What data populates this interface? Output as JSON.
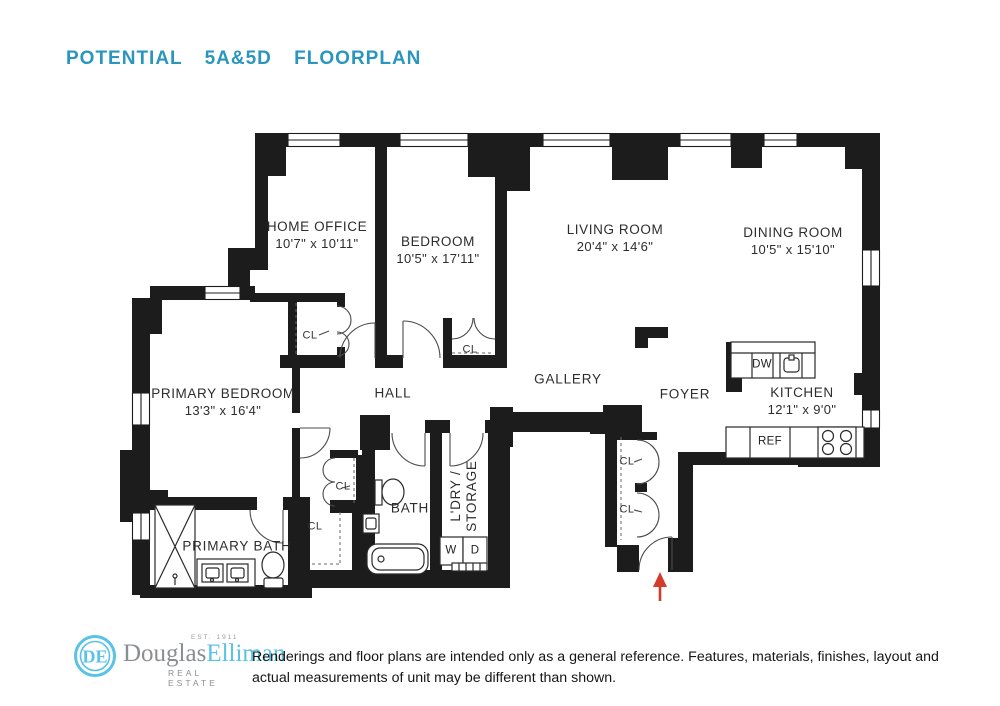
{
  "title": "POTENTIAL  5A&5D  FLOORPLAN",
  "colors": {
    "accent_teal": "#2a96bd",
    "wall_black": "#1c1c1c",
    "arrow_red": "#d23b29",
    "logo_blue": "#5bc2e7",
    "logo_gray": "#8b8e91"
  },
  "rooms": [
    {
      "id": "home-office",
      "name": "HOME OFFICE",
      "dims": "10'7\" x 10'11\""
    },
    {
      "id": "bedroom",
      "name": "BEDROOM",
      "dims": "10'5\" x 17'11\""
    },
    {
      "id": "living-room",
      "name": "LIVING ROOM",
      "dims": "20'4\" x 14'6\""
    },
    {
      "id": "dining-room",
      "name": "DINING ROOM",
      "dims": "10'5\" x 15'10\""
    },
    {
      "id": "primary-bedroom",
      "name": "PRIMARY BEDROOM",
      "dims": "13'3\" x 16'4\""
    },
    {
      "id": "kitchen",
      "name": "KITCHEN",
      "dims": "12'1\" x 9'0\""
    }
  ],
  "areas": {
    "hall": "HALL",
    "gallery": "GALLERY",
    "foyer": "FOYER",
    "bath": "BATH",
    "primary_bath": "PRIMARY BATH",
    "laundry_line1": "L'DRY /",
    "laundry_line2": "STORAGE"
  },
  "closets": {
    "label": "CL"
  },
  "appliances": {
    "dishwasher": "DW",
    "refrigerator": "REF",
    "washer": "W",
    "dryer": "D"
  },
  "logo": {
    "monogram": "DE",
    "brand_first": "Douglas",
    "brand_second": "Elliman",
    "est": "EST. 1911",
    "tagline": "REAL ESTATE"
  },
  "disclaimer": "Renderings and floor plans are intended only as a general reference. Features, materials, finishes, layout and actual measurements of unit may be different than shown."
}
